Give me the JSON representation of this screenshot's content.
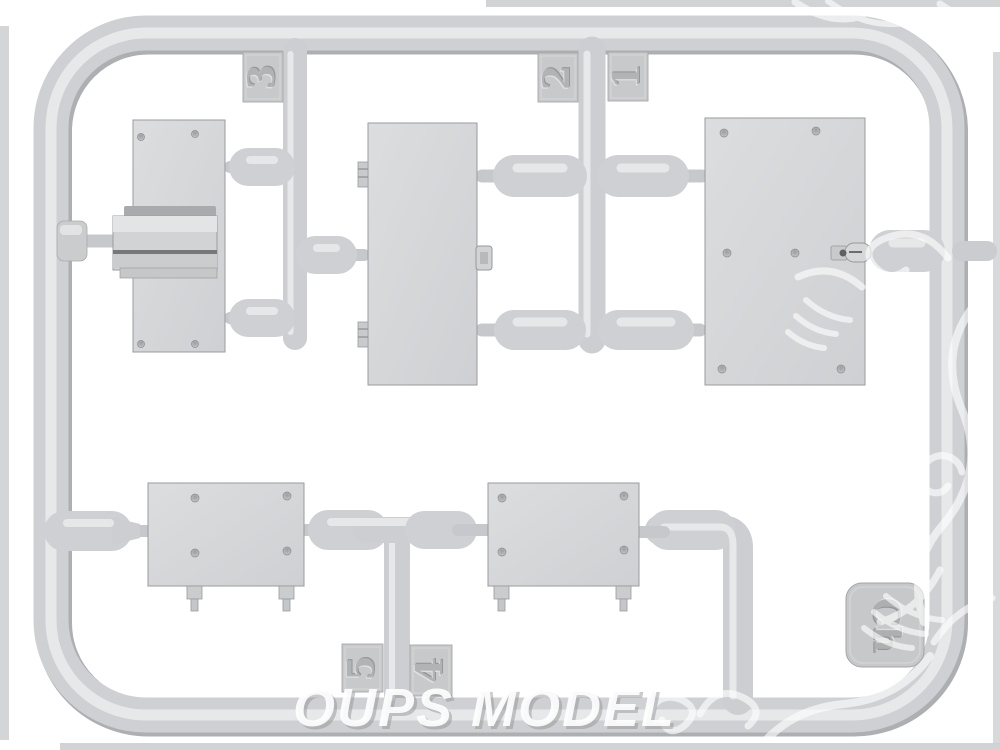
{
  "sprue": {
    "tags": {
      "n1": "1",
      "n2": "2",
      "n3": "3",
      "n4": "4",
      "n5": "5",
      "letter": "Ch"
    }
  },
  "watermark": {
    "text": "OUPS MODEL"
  },
  "colors": {
    "background": "#ffffff",
    "plastic_base": "#cfd0d3",
    "plastic_highlight": "#e9eaec",
    "plastic_shadow": "#aeafb2",
    "panel_fill": "#d8d9db",
    "panel_edge": "#9a9b9e",
    "watermark_white": "#ffffff"
  }
}
